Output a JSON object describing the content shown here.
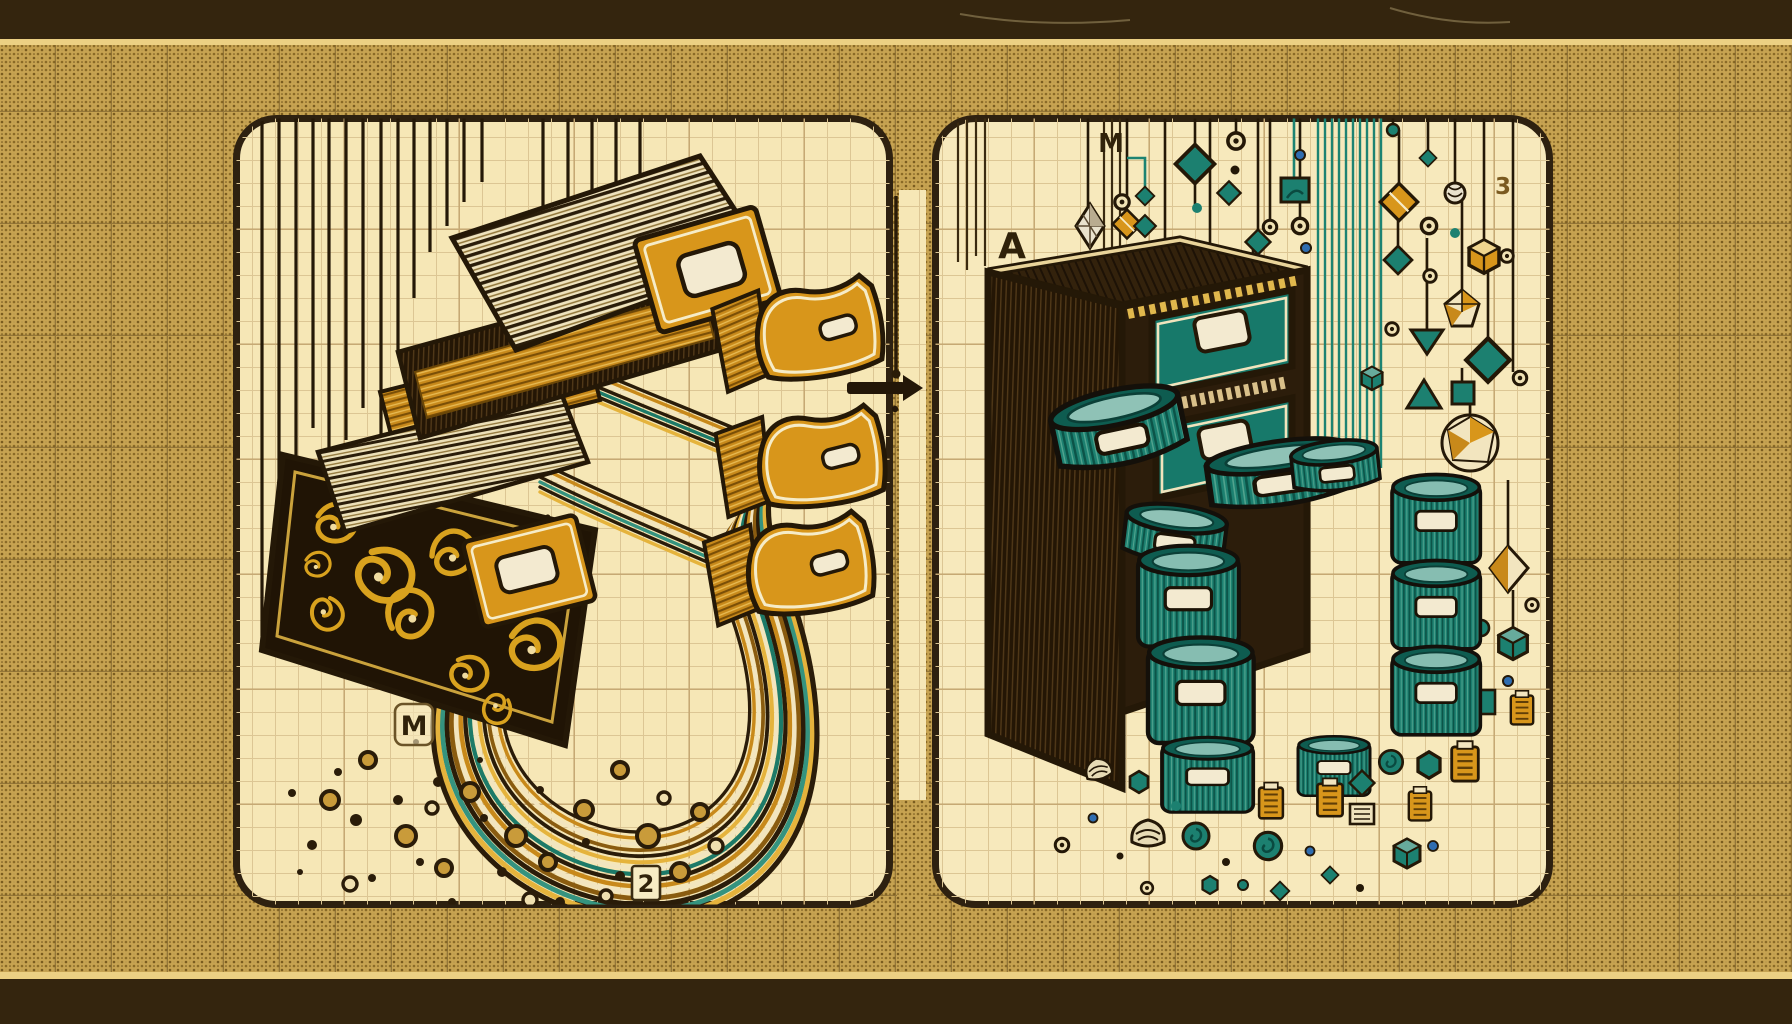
{
  "illustration": {
    "theme": "vintage blueprint illustration: ornate card-catalog spilling streams of cards (left) transformed into a structured cabinet with cylindrical containers and hanging geometric tokens (right)",
    "palette": {
      "background_gold": "#c7a351",
      "band_brown": "#34250e",
      "gold_separator": "#ecd083",
      "panel_cream": "#f6e7b6",
      "ink_dark": "#241807",
      "accent_gold": "#d8961b",
      "accent_teal": "#1c8070",
      "accent_blue": "#2f6db0",
      "label_cream": "#f3ead0"
    },
    "panels": {
      "left": {
        "tag_m": "M",
        "tag_2": "2"
      },
      "right": {
        "tag_a": "A",
        "tag_m": "M",
        "tag_3": "3"
      }
    }
  }
}
